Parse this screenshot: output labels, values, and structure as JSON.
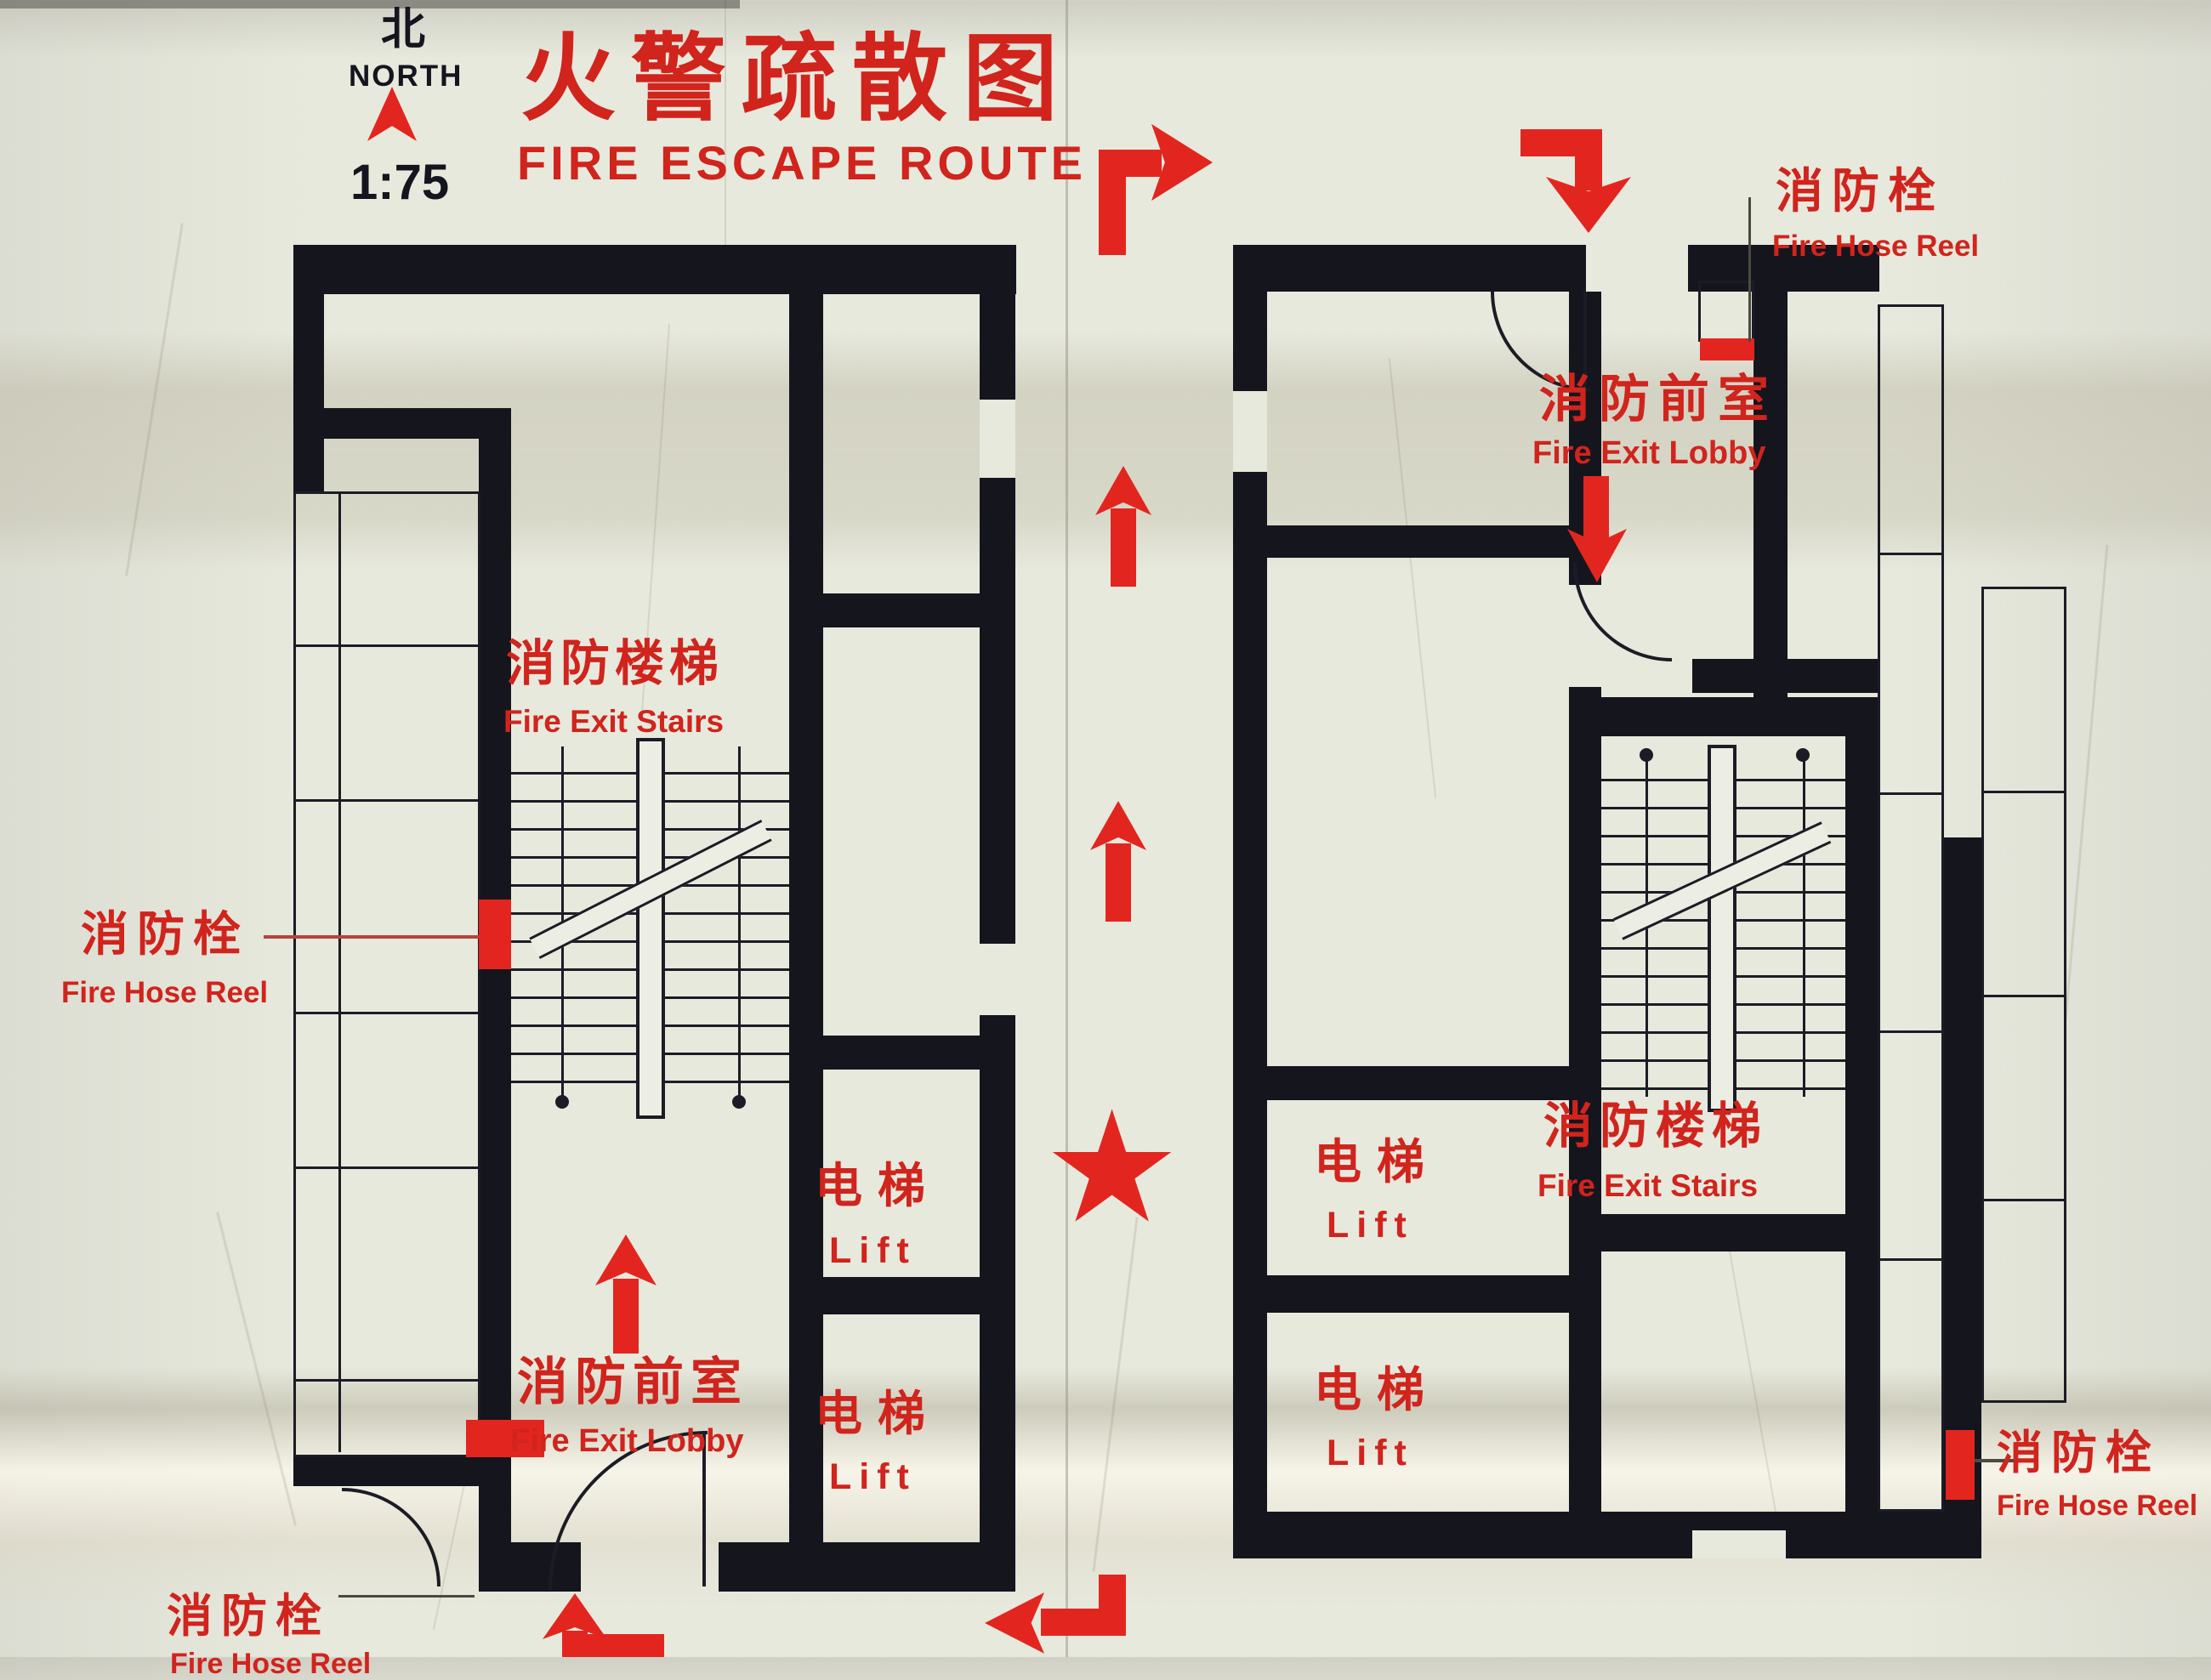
{
  "header": {
    "north_zh": "北",
    "north_en": "NORTH",
    "scale": "1:75",
    "title_zh": "火警疏散图",
    "title_en": "FIRE ESCAPE ROUTE"
  },
  "labels": {
    "hose_zh": "消防栓",
    "hose_en": "Fire Hose Reel",
    "lobby_zh": "消防前室",
    "lobby_en": "Fire Exit Lobby",
    "stairs_zh": "消防楼梯",
    "stairs_en": "Fire Exit Stairs",
    "lift_zh": "电梯",
    "lift_en": "Lift"
  },
  "symbols": {
    "star": "★"
  },
  "colors": {
    "red": "#e2261f",
    "wall": "#15151e",
    "marble": "#e7e9dd"
  }
}
